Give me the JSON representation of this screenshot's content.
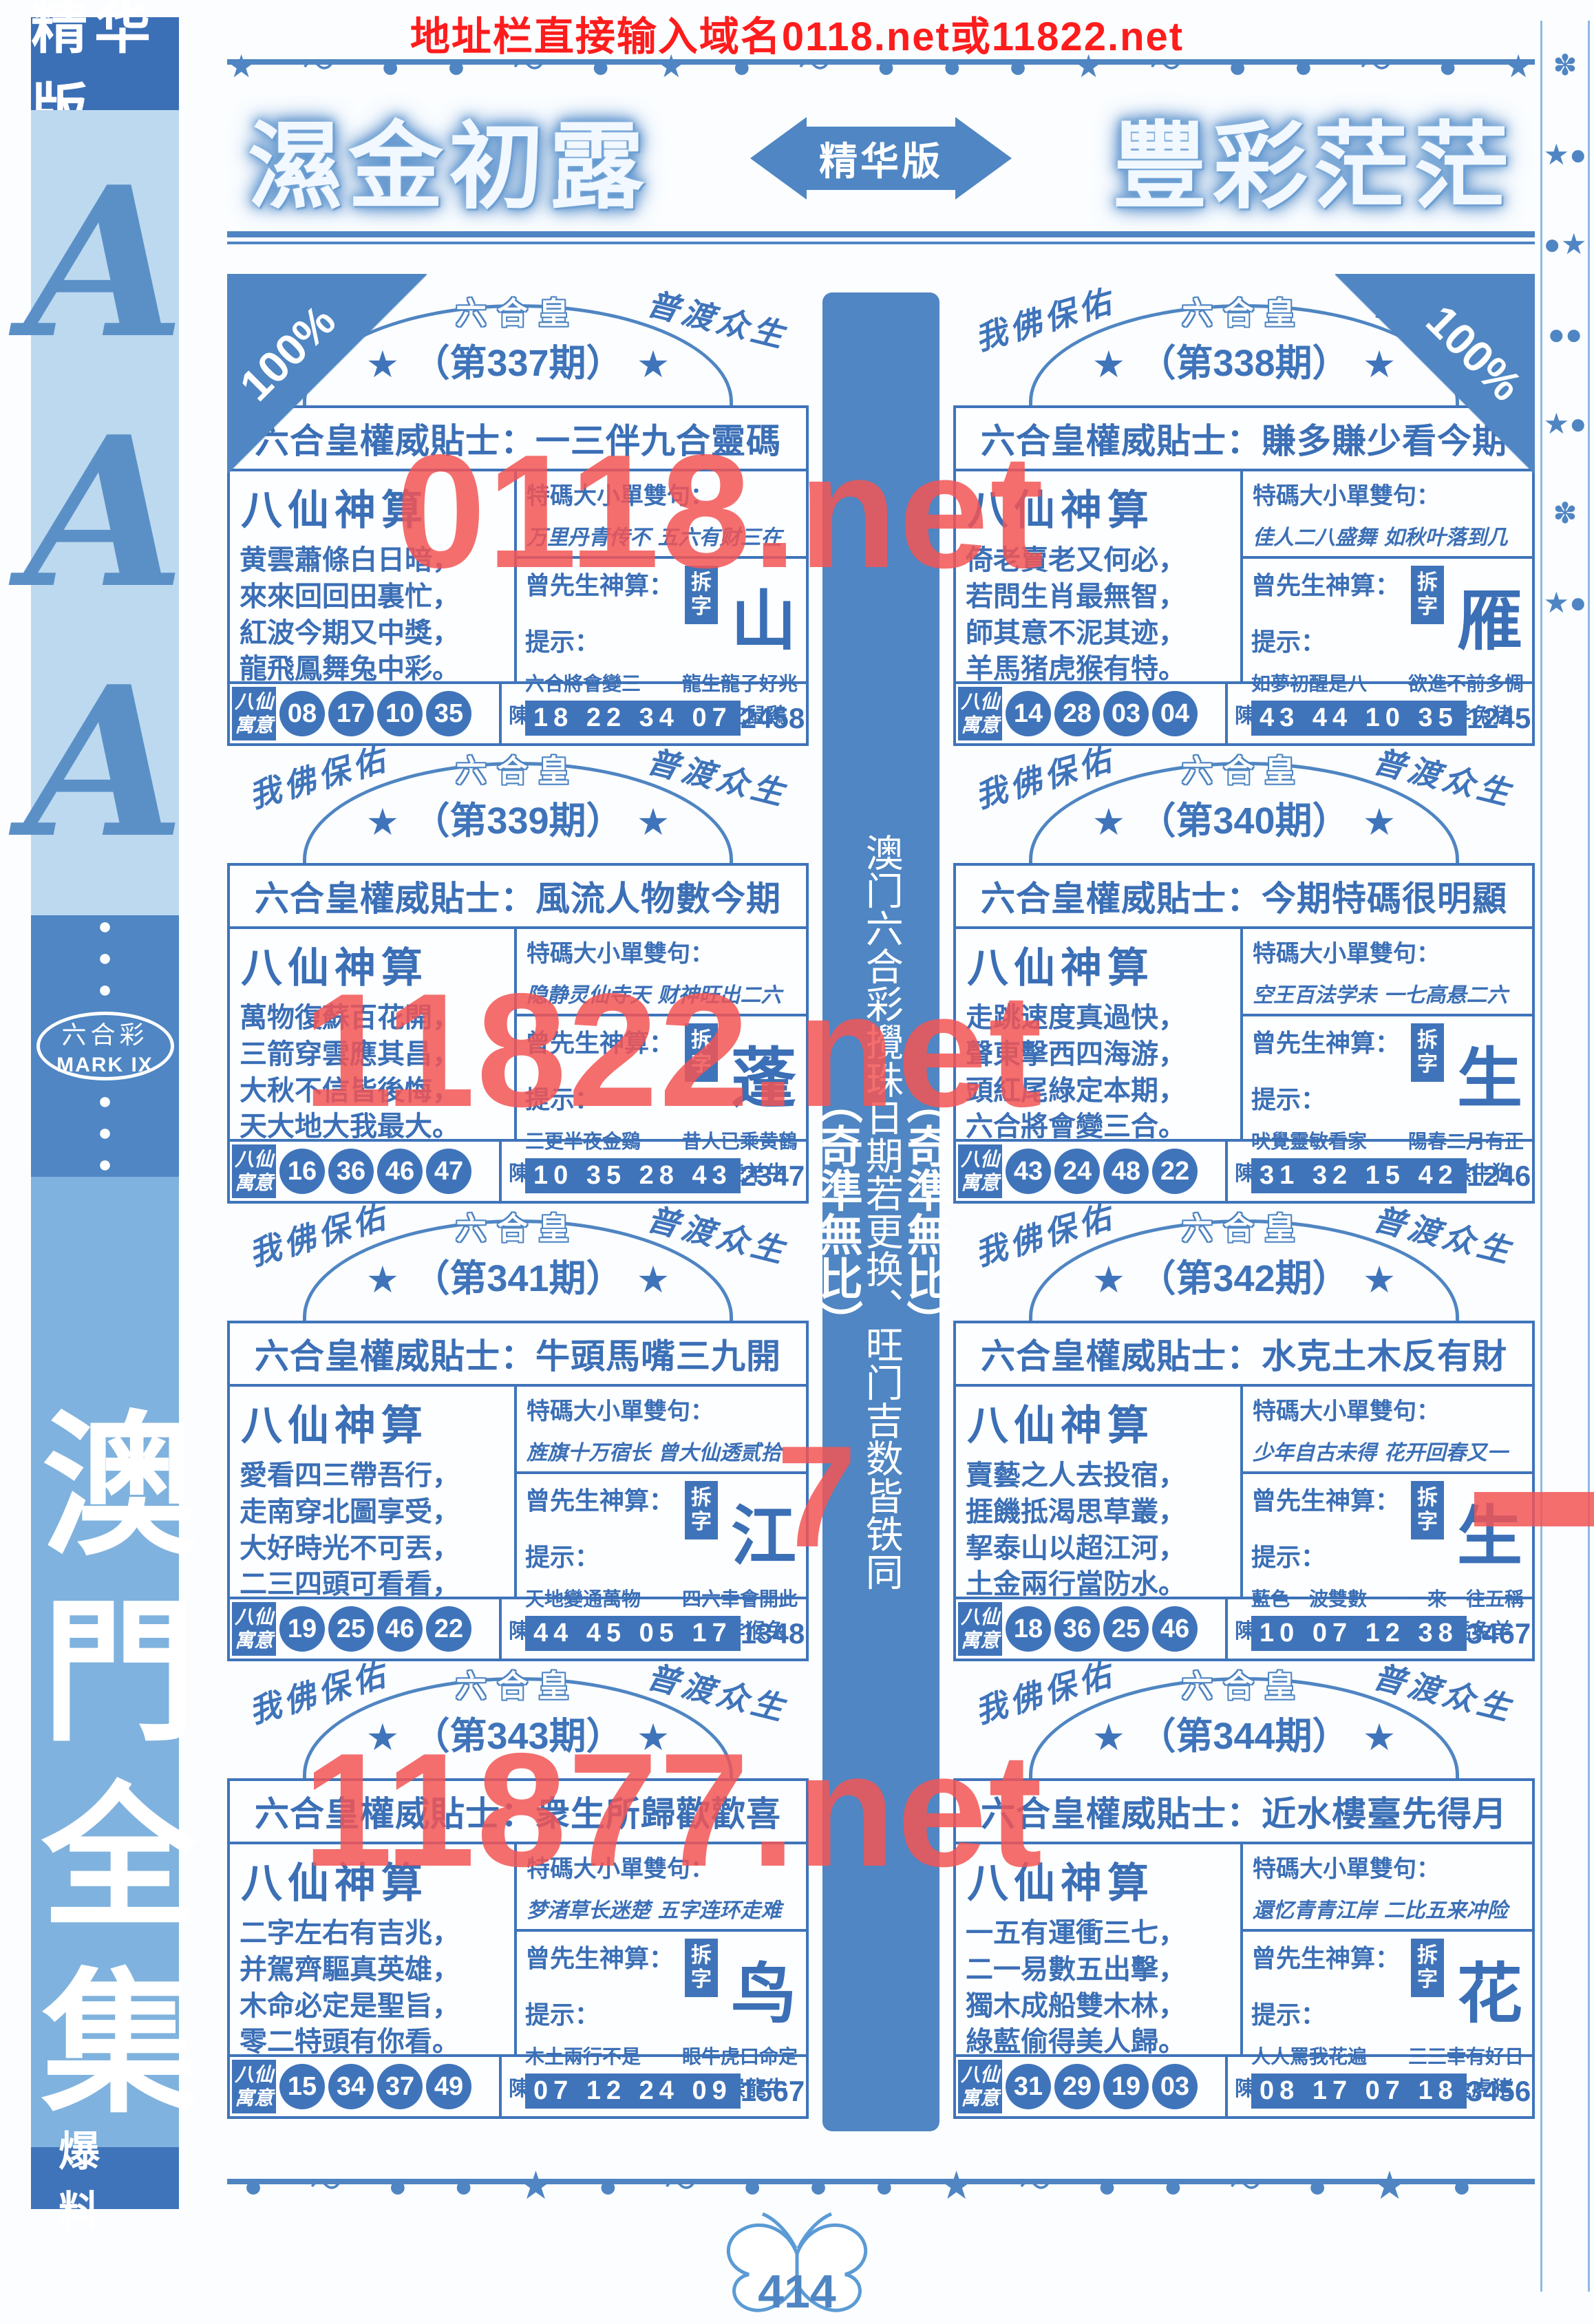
{
  "top_banner": {
    "text": "地址栏直接输入域名0118.net或11822.net"
  },
  "ornaments": {
    "top_row": "★～●●～●★●～●●●★～●●～●★",
    "bottom_row": "●～●●★●～●●●★～●●～●★●",
    "right_strip": "✽★●●★●●★●✽★●",
    "dots": "●●●"
  },
  "sidebar": {
    "edition_label": "精华版",
    "aaa": [
      "A",
      "A",
      "A"
    ],
    "logo": {
      "line1": "六合彩",
      "line2": "MARK IX"
    },
    "collection_title": "澳門全集",
    "bottom_label": "爆料"
  },
  "masthead": {
    "left_title": "濕金初露",
    "center_label": "精华版",
    "right_title": "豐彩茫茫",
    "corner_left": "100%",
    "corner_right": "100%"
  },
  "center_strip": {
    "top_label": "（奇準無比）",
    "body": "澳门六合彩攪珠日期若更换、旺门吉数皆铁同",
    "bottom_label": "（奇準無比）"
  },
  "arc": {
    "left_blessing": "我佛保佑",
    "right_blessing": "普渡众生",
    "brand": "六合皇",
    "star": "★"
  },
  "labels": {
    "tip_label": "六合皇權威貼士：",
    "fortune_title": "八仙神算",
    "verse_label": "特碼大小單雙句：",
    "master_label": "曾先生神算：",
    "split_label": "拆字",
    "hint_label": "提示：",
    "bajia_label": "八仙寓意",
    "zodiac_label": "陳伯六合彩生肖提供："
  },
  "columns": {
    "left": [
      {
        "issue": "（第337期）",
        "tip": "一三伴九合靈碼",
        "poem": [
          "黄雲蕭條白日暗，",
          "來來回回田裏忙，",
          "紅波今期又中獎，",
          "龍飛鳳舞兔中彩。"
        ],
        "verse": "万里丹青传不 五六有财三在",
        "split_char": "山",
        "hint_left": "六合將會變三",
        "hint_right": "龍生龍子好兆",
        "numbers": "18 22 34 07",
        "code": "2458",
        "circles": [
          "08",
          "17",
          "10",
          "35"
        ],
        "zodiac": "蛇鼠鷄"
      },
      {
        "issue": "（第339期）",
        "tip": "風流人物數今期",
        "poem": [
          "萬物復蘇百花開，",
          "三箭穿雲應其昌，",
          "大秋不信皆後悔，",
          "天大地大我最大。"
        ],
        "verse": "隐静灵仙寺天 财神旺出二六",
        "split_char": "蓬",
        "hint_left": "三更半夜金鷄",
        "hint_right": "昔人已乘黄鶴",
        "numbers": "10 35 28 43",
        "code": "2347",
        "circles": [
          "16",
          "36",
          "46",
          "47"
        ],
        "zodiac": "虎羊牛"
      },
      {
        "issue": "（第341期）",
        "tip": "牛頭馬嘴三九開",
        "poem": [
          "愛看四三帶吾行，",
          "走南穿北圖享受，",
          "大好時光不可丟，",
          "二三四頭可看看，"
        ],
        "verse": "旌旗十万宿长 曾大仙透贰拾",
        "split_char": "江",
        "hint_left": "天地變通萬物",
        "hint_right": "四六幸會開此",
        "numbers": "44 45 05 17",
        "code": "1348",
        "circles": [
          "19",
          "25",
          "46",
          "22"
        ],
        "zodiac": "羊猴兔"
      },
      {
        "issue": "（第343期）",
        "tip": "衆生所歸歡歡喜",
        "poem": [
          "二字左右有吉兆，",
          "并駕齊驅真英雄，",
          "木命必定是聖旨，",
          "零二特頭有你看。"
        ],
        "verse": "梦渚草长迷楚 五字连环走难",
        "split_char": "鸟",
        "hint_left": "木土兩行不是",
        "hint_right": "眼牛虎口命定",
        "numbers": "07 12 24 09",
        "code": "1567",
        "circles": [
          "15",
          "34",
          "37",
          "49"
        ],
        "zodiac": "猴龍牛"
      }
    ],
    "right": [
      {
        "issue": "（第338期）",
        "tip": "賺多賺少看今期",
        "poem": [
          "倚老賣老又何必，",
          "若問生肖最無智，",
          "師其意不泥其迹，",
          "羊馬猪虎猴有特。"
        ],
        "verse": "佳人二八盛舞 如秋叶落到几",
        "split_char": "雁",
        "hint_left": "如夢初醒是八",
        "hint_right": "欲進不前多惆",
        "numbers": "43 44 10 35",
        "code": "1245",
        "circles": [
          "14",
          "28",
          "03",
          "04"
        ],
        "zodiac": "羊兔猪"
      },
      {
        "issue": "（第340期）",
        "tip": "今期特碼很明顯",
        "poem": [
          "走跳速度真過快，",
          "聲東擊西四海游，",
          "頭紅尾綠定本期，",
          "六合將會變三合。"
        ],
        "verse": "空王百法学未 一七高悬二六",
        "split_char": "生",
        "hint_left": "吠覺靈敏看家",
        "hint_right": "陽春二月有正",
        "numbers": "31 32 15 42",
        "code": "1246",
        "circles": [
          "43",
          "24",
          "48",
          "22"
        ],
        "zodiac": "猴牛狗"
      },
      {
        "issue": "（第342期）",
        "tip": "水克土木反有財",
        "poem": [
          "賣藝之人去投宿，",
          "捱饑抵渴思草叢，",
          "挈泰山以超江河，",
          "土金兩行當防水。"
        ],
        "verse": "少年自古未得 花开回春又一",
        "split_char": "生",
        "hint_left": "藍色一波雙數",
        "hint_right": "一來一往五稱",
        "numbers": "10 07 12 38",
        "code": "3467",
        "circles": [
          "18",
          "36",
          "25",
          "46"
        ],
        "zodiac": "馬兔羊"
      },
      {
        "issue": "（第344期）",
        "tip": "近水樓臺先得月",
        "poem": [
          "一五有運衝三七，",
          "二一易數五出擊，",
          "獨木成船雙木林，",
          "綠藍偷得美人歸。"
        ],
        "verse": "還忆青青江岸 二比五来冲险",
        "split_char": "花",
        "hint_left": "人人罵我花遍",
        "hint_right": "三三幸有好日",
        "numbers": "08 17 07 18",
        "code": "3456",
        "circles": [
          "31",
          "29",
          "19",
          "03"
        ],
        "zodiac": "兔虎猪"
      }
    ]
  },
  "watermarks": {
    "w1": "0118.net",
    "w2": "11822.net",
    "w3": "11877.net",
    "fragment": "7"
  },
  "footer": {
    "page_number": "414"
  }
}
